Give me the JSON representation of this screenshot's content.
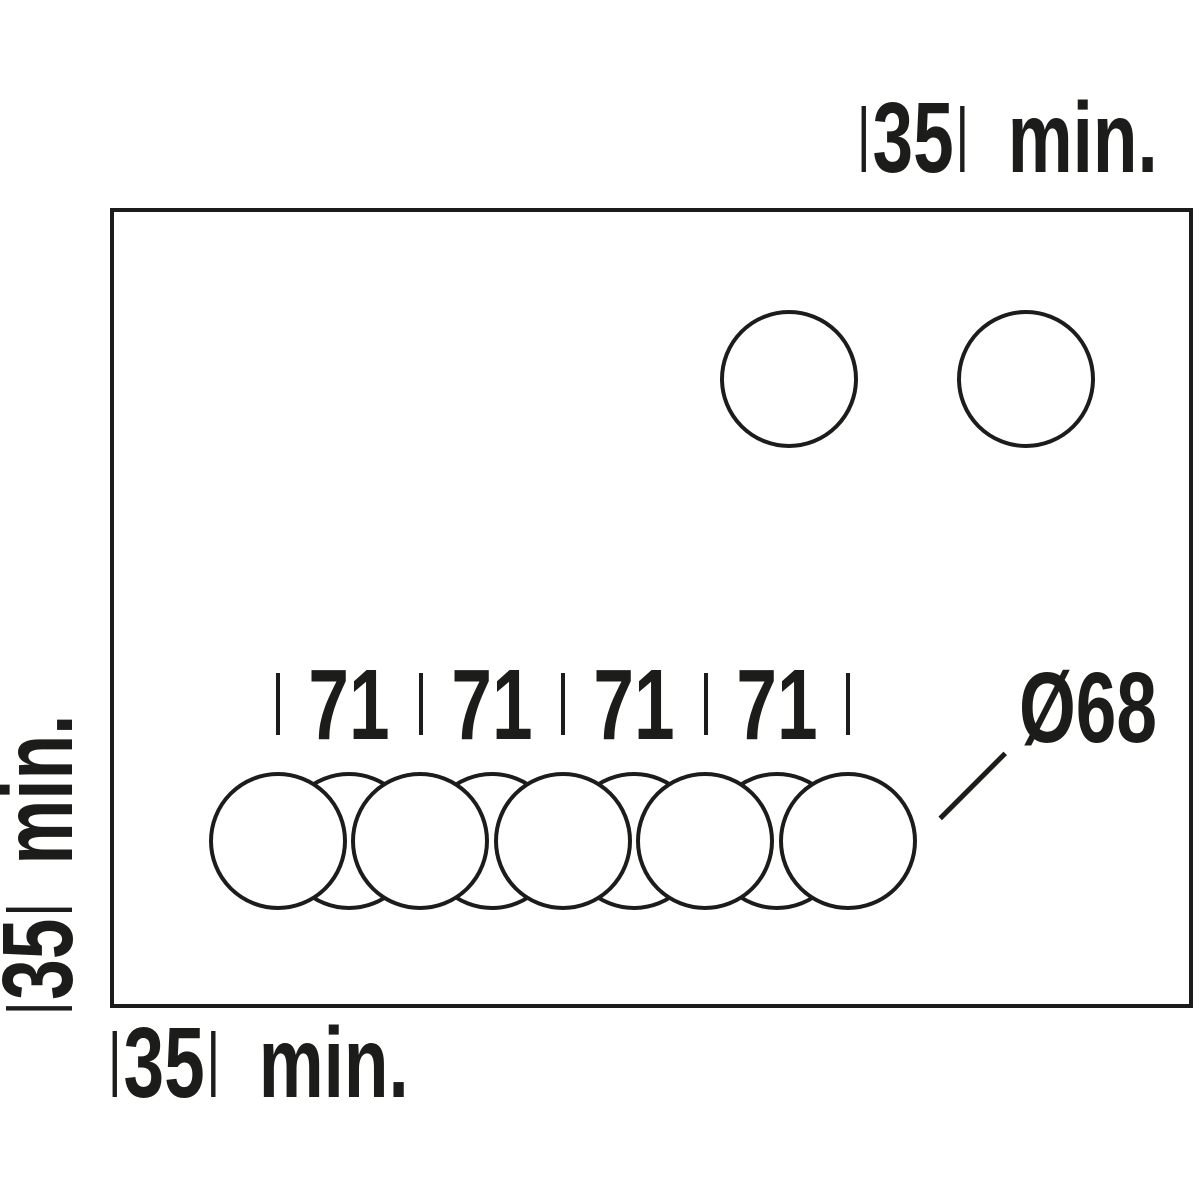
{
  "colors": {
    "line": "#1c1c1a",
    "background": "#ffffff"
  },
  "dimensions": {
    "top_clearance": {
      "value": "35",
      "unit": "min."
    },
    "left_clearance": {
      "value": "35",
      "unit": "min."
    },
    "bottom_clearance": {
      "value": "35",
      "unit": "min."
    },
    "hole_spacing": {
      "values": [
        "71",
        "71",
        "71",
        "71"
      ]
    },
    "hole_diameter": {
      "label": "Ø68"
    }
  }
}
